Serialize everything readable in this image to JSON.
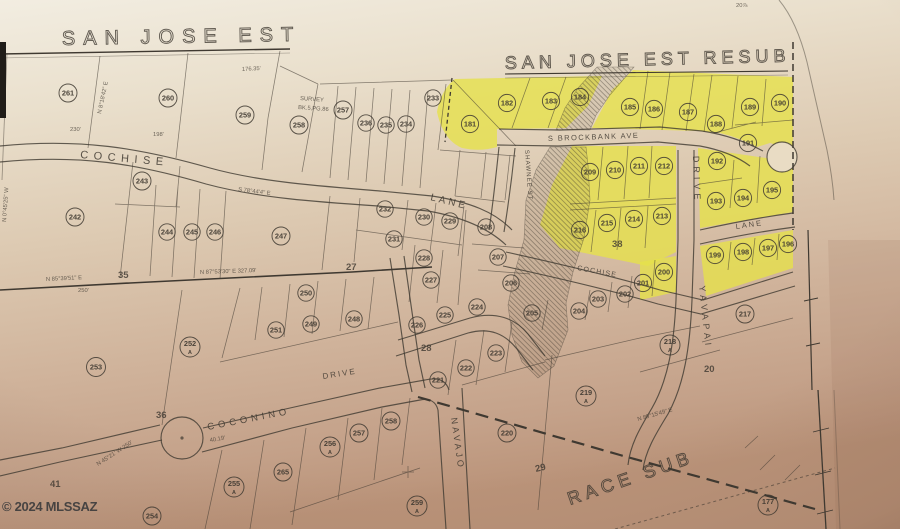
{
  "photo": {
    "watermark": "© 2024 MLSSAZ",
    "page_note": "20⅞"
  },
  "titles": {
    "main": "SAN JOSE EST",
    "resub": "SAN JOSE EST RESUB",
    "south": "RACE SUB"
  },
  "survey_note": {
    "line1": "SURVEY",
    "line2": "BK.5,PG.86"
  },
  "streets": {
    "cochise_w": "COCHISE",
    "lane_mid": "LANE",
    "brockbank": "S BROCKBANK AVE",
    "shawnee": "SHAWNEE ST",
    "yavapai_drive": "DRIVE",
    "yavapai": "YAVAPAI",
    "cochise_e": "COCHISE",
    "lane_e": "LANE",
    "coconino": "COCONINO",
    "coconino_drive": "DRIVE",
    "navajo": "NAVAJO"
  },
  "annotations": {
    "bearing_sw": "N 85°39'51\" E",
    "sec_35": "35",
    "bearing_s": "N 87°53'30\" E  327.09'",
    "sec_27": "27",
    "dim_250": "250'",
    "dim_230": "230'",
    "dim_198": "198'",
    "dim_176": "176.35'",
    "bearing_cochise": "S 78°44'4\" E",
    "bearing_coconino": "N 45°21' W  250'",
    "sec_41": "41",
    "sec_36": "36",
    "bearing_se": "N 89°15'49\" E",
    "bearing_w_edge": "N 0°45'25\" W",
    "bearing_nw": "N 8°18'42\" E",
    "dim_4019": "40.19'",
    "sec_38": "38",
    "sec_20": "20",
    "sec_29": "29",
    "sec_28": "28"
  },
  "lots": {
    "261": "261",
    "260": "260",
    "259": "259",
    "258t": "258",
    "257t": "257",
    "236": "236",
    "235": "235",
    "234": "234",
    "233": "233",
    "243": "243",
    "242": "242",
    "244": "244",
    "245": "245",
    "246": "246",
    "247": "247",
    "232": "232",
    "230": "230",
    "229": "229",
    "231": "231",
    "228": "228",
    "227": "227",
    "208": "208",
    "207": "207",
    "206": "206",
    "205": "205",
    "204": "204",
    "203": "203",
    "202": "202",
    "226": "226",
    "225": "225",
    "224": "224",
    "223": "223",
    "222": "222",
    "221": "221",
    "253": "253",
    "252A": "252",
    "250": "250",
    "251": "251",
    "249": "249",
    "248": "248",
    "254": "254",
    "255A": "255",
    "265": "265",
    "256A": "256",
    "257b": "257",
    "258b": "258",
    "259A": "259",
    "219A": "219",
    "220": "220",
    "218A": "218",
    "217": "217",
    "177A": "177",
    "181": "181",
    "182": "182",
    "183": "183",
    "184": "184",
    "185": "185",
    "186": "186",
    "187": "187",
    "188": "188",
    "189": "189",
    "190": "190",
    "191": "191",
    "192": "192",
    "193": "193",
    "194": "194",
    "195": "195",
    "196": "196",
    "197": "197",
    "198": "198",
    "199": "199",
    "200": "200",
    "201": "201",
    "209": "209",
    "210": "210",
    "211": "211",
    "212": "212",
    "213": "213",
    "214": "214",
    "215": "215",
    "216": "216"
  },
  "suffixes": {
    "252A": "A",
    "255A": "A",
    "256A": "A",
    "259A": "A",
    "219A": "A",
    "218A": "A",
    "177A": "A"
  },
  "colors": {
    "highlight": "#e6e14b",
    "ink": "#3f3931",
    "paper_light": "#f0ebdf",
    "paper_dark": "#bd977f",
    "watermark": "#3e3d3d"
  }
}
